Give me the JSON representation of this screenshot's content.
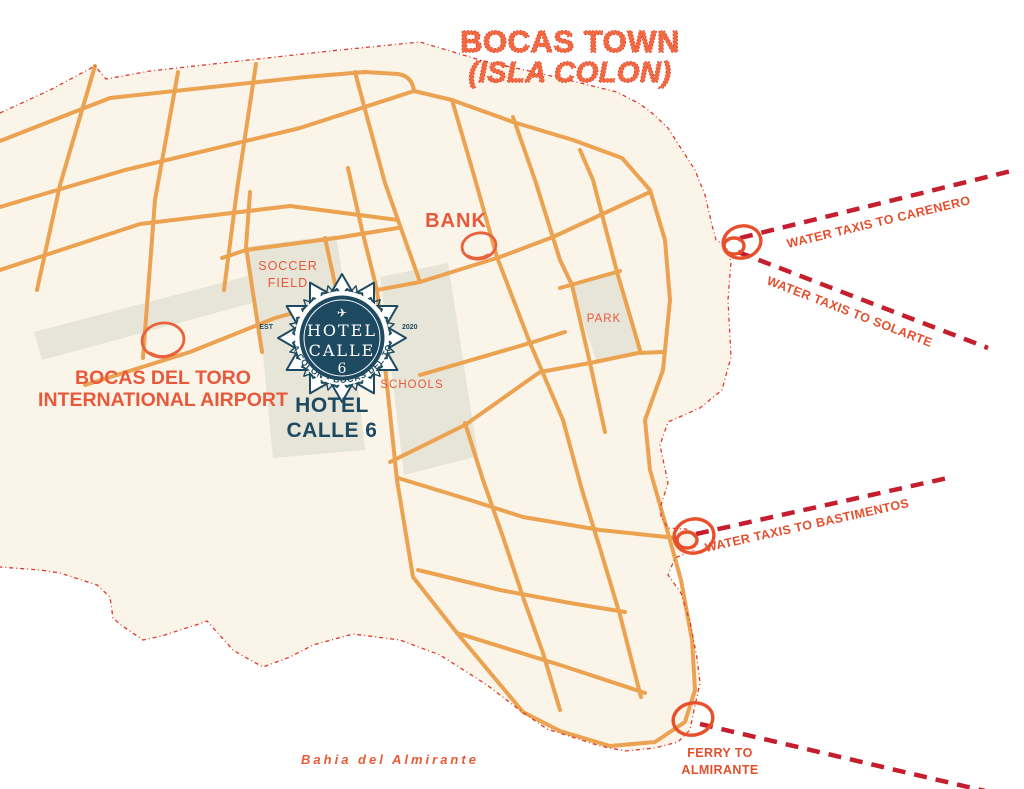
{
  "title": {
    "line1": "BOCAS TOWN",
    "line2": "(ISLA COLON)"
  },
  "logo": {
    "hotel": "HOTEL",
    "calle": "CALLE",
    "number": "6",
    "arc_text": "ISLA COLON - BOCAS DEL TORO",
    "est": "EST",
    "year": "2020",
    "plane_icon": "✈"
  },
  "hotel_label": {
    "line1": "HOTEL",
    "line2": "CALLE 6"
  },
  "landmarks": {
    "bank": "BANK",
    "soccer_field": [
      "SOCCER",
      "FIELD"
    ],
    "park": "PARK",
    "schools": "SCHOOLS",
    "airport": [
      "BOCAS DEL TORO",
      "INTERNATIONAL AIRPORT"
    ]
  },
  "routes": {
    "carenero": "WATER TAXIS TO CARENERO",
    "solarte": "WATER TAXIS TO SOLARTE",
    "bastimentos": "WATER TAXIS TO BASTIMENTOS",
    "ferry": [
      "FERRY TO",
      "ALMIRANTE"
    ]
  },
  "water_label": "Bahia del Almirante",
  "colors": {
    "land": "#FBF4E8",
    "water": "#FFFFFF",
    "street_orange": "#EBA251",
    "block_gray": "#E7E5D8",
    "coastline_red": "#E0392B",
    "route_red": "#C41E2F",
    "label_orange": "#E8593C",
    "title_orange": "#F2683F",
    "logo_navy": "#1D4A61"
  }
}
